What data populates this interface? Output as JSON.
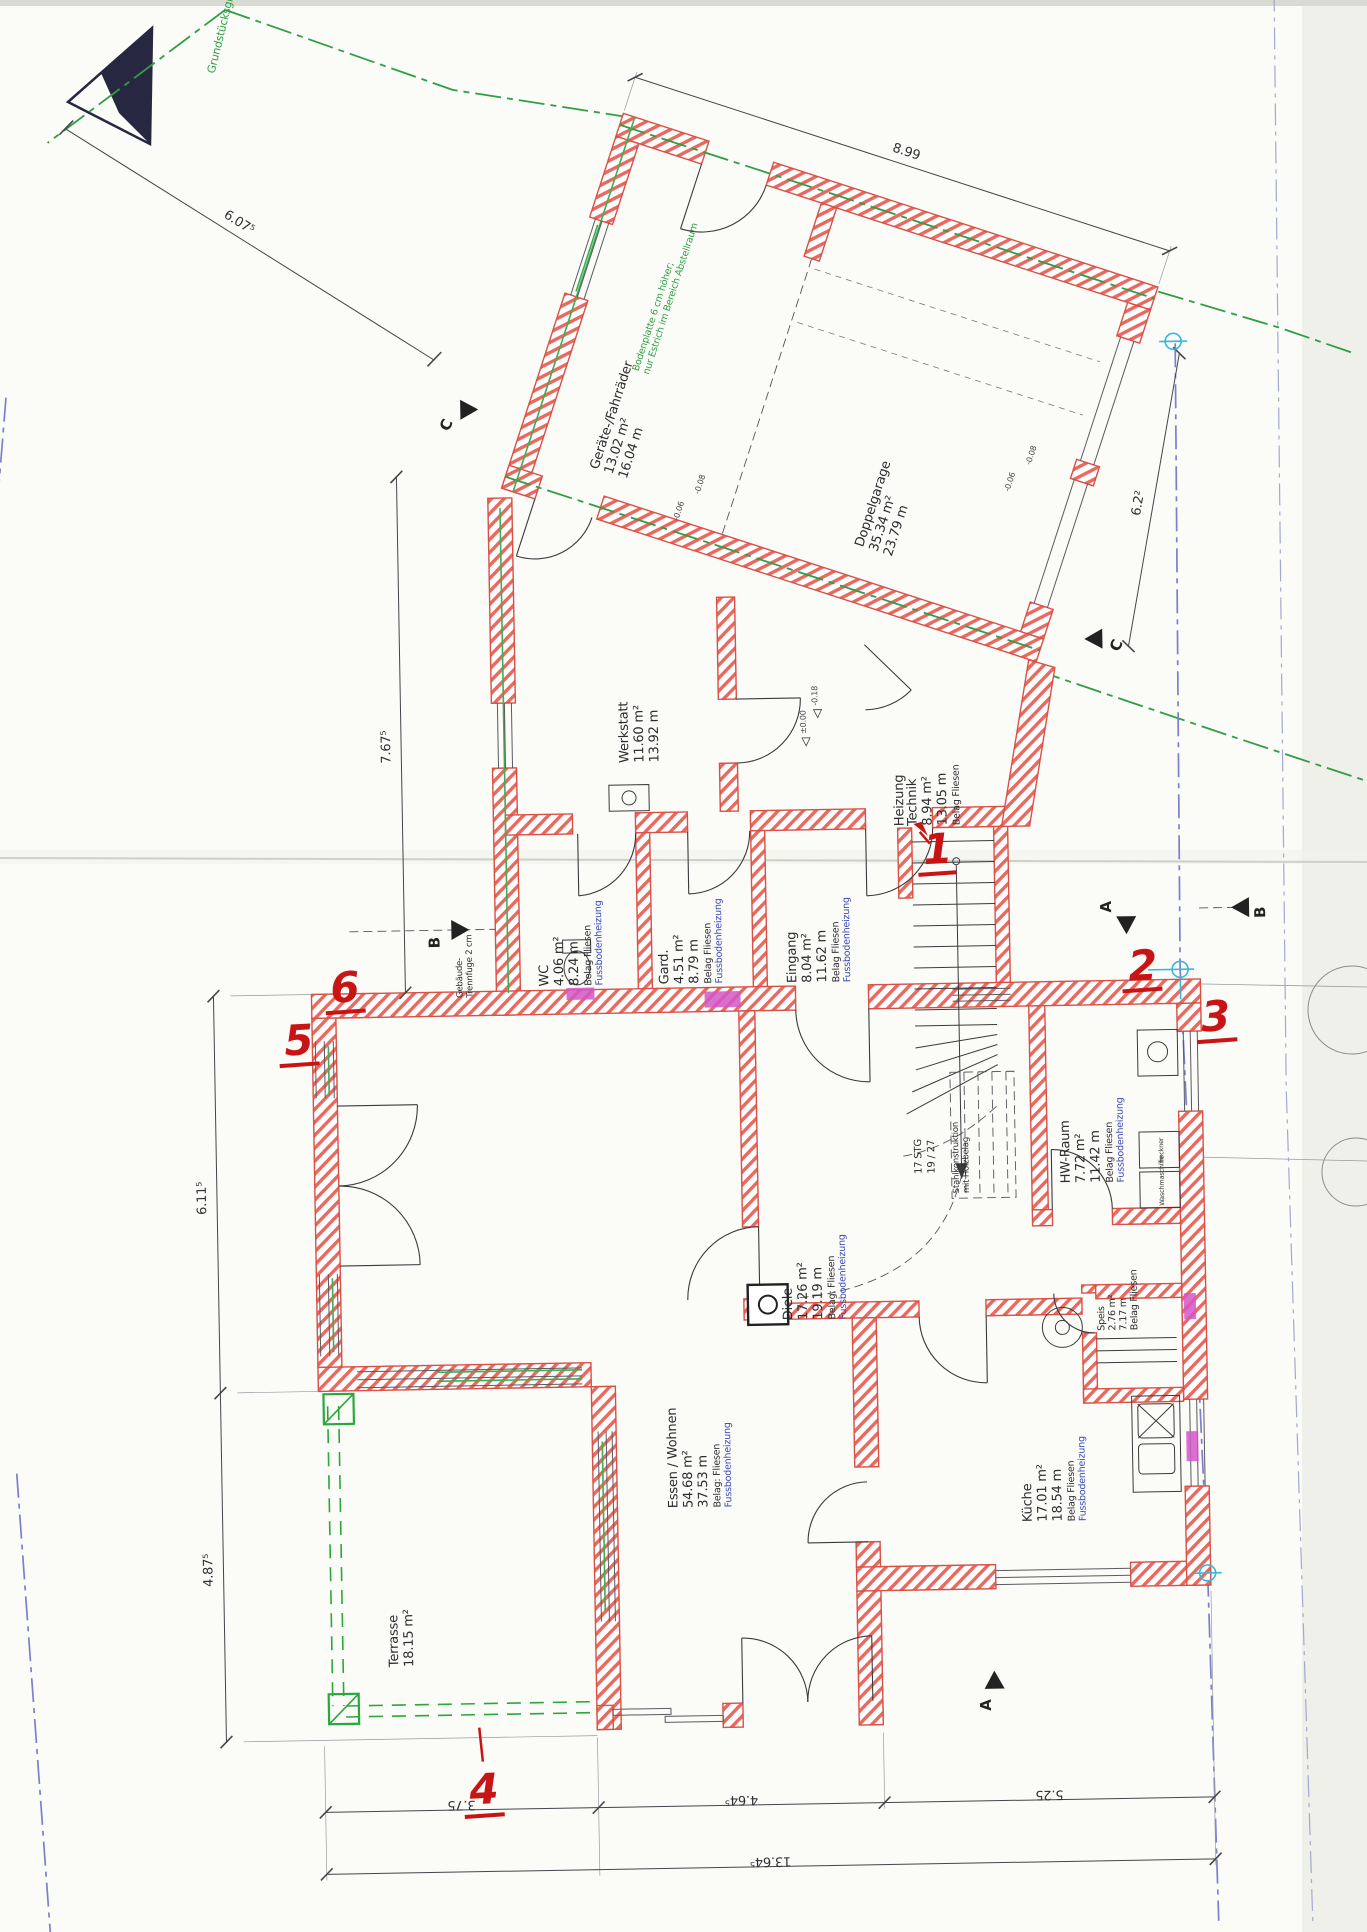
{
  "boundary": {
    "label": "Grundstücksgrenze"
  },
  "rooms": [
    {
      "name": "Geräte-/Fahrräder",
      "area": "13.02 m²",
      "perimeter": "16.04 m"
    },
    {
      "name": "Doppelgarage",
      "area": "35.34 m²",
      "perimeter": "23.79 m"
    },
    {
      "name": "Werkstatt",
      "area": "11.60 m²",
      "perimeter": "13.92 m"
    },
    {
      "name": "Heizung",
      "name2": "Technik",
      "area": "8.94 m²",
      "perimeter": "13.05 m",
      "flooring": "Belag Fliesen"
    },
    {
      "name": "WC",
      "area": "4.06 m²",
      "perimeter": "8.24 m",
      "flooring": "Belag Fliesen",
      "heating": "Fussbodenheizung"
    },
    {
      "name": "Gard.",
      "area": "4.51 m²",
      "perimeter": "8.79 m",
      "flooring": "Belag Fliesen",
      "heating": "Fussbodenheizung"
    },
    {
      "name": "Eingang",
      "area": "8.04 m²",
      "perimeter": "11.62 m",
      "flooring": "Belag Fliesen",
      "heating": "Fussbodenheizung"
    },
    {
      "name": "HW-Raum",
      "area": "7.72 m²",
      "perimeter": "11.42 m",
      "flooring": "Belag Fliesen",
      "heating": "Fussbodenheizung"
    },
    {
      "name": "Diele",
      "area": "17.26 m²",
      "perimeter": "19.19 m",
      "flooring": "Belag: Fliesen",
      "heating": "Fussbodenheizung"
    },
    {
      "name": "Speis",
      "area": "2.76 m²",
      "perimeter": "7.17 m",
      "flooring": "Belag Fliesen"
    },
    {
      "name": "Küche",
      "area": "17.01 m²",
      "perimeter": "18.54 m",
      "flooring": "Belag Fliesen",
      "heating": "Fussbodenheizung"
    },
    {
      "name": "Essen / Wohnen",
      "area": "54.68 m²",
      "perimeter": "37.53 m",
      "flooring": "Belag: Fliesen",
      "heating": "Fussbodenheizung"
    },
    {
      "name": "Terrasse",
      "area": "18.15 m²"
    }
  ],
  "stair": {
    "steps": "17 STG",
    "rise_run": "19 / 27",
    "note1": "Stahlkonstruktion",
    "note2": "mit Holzbelag"
  },
  "notes": {
    "bodenplatte1": "Bodenplatte 6 cm höher;",
    "bodenplatte2": "nur Estrich im Bereich Abstellraum",
    "trennfuge1": "Gebäude-",
    "trennfuge2": "Trennfuge 2 cm"
  },
  "fixtures": {
    "dryer": "Trockner",
    "washer": "Waschmaschine"
  },
  "dimensions": {
    "top": "8.99",
    "top_left": "6.07⁵",
    "left_mid": "7.67⁵",
    "left_upper": "6.11⁵",
    "left_lower": "4.87⁵",
    "right": "6.2²",
    "bottom": [
      "3.75",
      "4.64⁵",
      "5.25"
    ],
    "bottom_total": "13.64⁵"
  },
  "annotations": {
    "red_numbers": [
      "1",
      "2",
      "3",
      "4",
      "5",
      "6"
    ]
  },
  "section_markers": [
    "C",
    "C",
    "B",
    "B",
    "A",
    "A"
  ],
  "level_marks": [
    "-0.08",
    "-0.06",
    "-0.08",
    "-0.06",
    "-0.18",
    "±0.00"
  ],
  "colors": {
    "wall_red": "#d95045",
    "boundary_green": "#2f9e44",
    "terrace_green": "#2aa83c",
    "boundary_blue": "#7a7fd0",
    "marker_cyan": "#3ab6dc",
    "highlight_magenta": "#d257c8",
    "annotation_red": "#c81414",
    "heating_text_blue": "#3a49b4"
  }
}
